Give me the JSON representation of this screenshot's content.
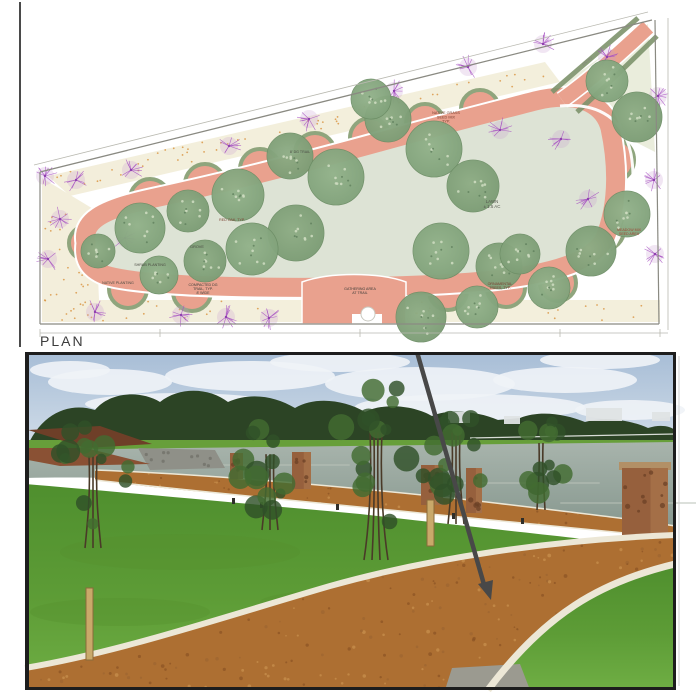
{
  "figure": {
    "plan_title": "PLAN",
    "description_labels": {
      "lawn": "LAWN\n± 1.5 AC"
    }
  },
  "plan": {
    "colors": {
      "trail": "#e9a18e",
      "trailEdge": "#ffffff",
      "bedRim": "#8fa57d",
      "lawn": "#dde3d5",
      "treeFill": "#85a87f",
      "treeFillAlt": "#7a9b72",
      "treeStroke": "#66885f",
      "treeSpeckle": "#ccdabf",
      "treeSpeckleDark": "#5f7f5c",
      "ornamental": "#a64fc2",
      "ornamentalDot": "#8e3fae",
      "ornamentalHalo": "#c79ad1",
      "underplant": "#f0ead2",
      "underplantDot": "#d8913c",
      "boundary": "#8a8a82",
      "boundaryLight": "#b9b9b0",
      "hedge": "#7d926c",
      "paleWedge": "#e6ead6",
      "label": "#3c3c3c"
    },
    "annotations": [
      {
        "x": 446,
        "y": 114,
        "text": "NATIVE GRASS\nSEED MIX\nTYP.",
        "c": "#7a4030",
        "fs": 3.8
      },
      {
        "x": 300,
        "y": 153,
        "text": "8' DG TRAIL",
        "c": "#4a4a42",
        "fs": 3.6
      },
      {
        "x": 492,
        "y": 203,
        "text": "LAWN\n± 1.5 AC",
        "c": "#55584e",
        "fs": 4.4
      },
      {
        "x": 232,
        "y": 221,
        "text": "RED OAK, TYP.",
        "c": "#7a4030",
        "fs": 3.6
      },
      {
        "x": 197,
        "y": 248,
        "text": "GROVE",
        "c": "#4a4a42",
        "fs": 3.8
      },
      {
        "x": 150,
        "y": 266,
        "text": "SHRUB PLANTING",
        "c": "#4a4a42",
        "fs": 3.6
      },
      {
        "x": 118,
        "y": 284,
        "text": "NATIVE PLANTING",
        "c": "#4a4a42",
        "fs": 3.6
      },
      {
        "x": 203,
        "y": 286,
        "text": "COMPACTED DG\nTRAIL, TYP.\n8' WIDE",
        "c": "#3c3c38",
        "fs": 3.6
      },
      {
        "x": 360,
        "y": 290,
        "text": "GATHERING AREA\nAT TRAIL",
        "c": "#3c3c38",
        "fs": 3.6
      },
      {
        "x": 500,
        "y": 285,
        "text": "ORNAMENTAL\nTREES, TYP.",
        "c": "#7a4030",
        "fs": 3.6
      },
      {
        "x": 629,
        "y": 231,
        "text": "MEADOW MIX\nSEED AREA",
        "c": "#a04434",
        "fs": 3.6
      },
      {
        "x": 588,
        "y": 62,
        "text": "ENTRY",
        "c": "#84847c",
        "fs": 3.6,
        "rot": -38
      }
    ],
    "trees_green": [
      [
        140,
        228,
        25
      ],
      [
        188,
        211,
        21
      ],
      [
        238,
        195,
        26
      ],
      [
        290,
        156,
        23
      ],
      [
        336,
        177,
        28
      ],
      [
        296,
        233,
        28
      ],
      [
        252,
        249,
        26
      ],
      [
        205,
        261,
        21
      ],
      [
        159,
        275,
        19
      ],
      [
        388,
        119,
        23
      ],
      [
        434,
        149,
        28
      ],
      [
        473,
        186,
        26
      ],
      [
        441,
        251,
        28
      ],
      [
        499,
        266,
        23
      ],
      [
        549,
        288,
        21
      ],
      [
        591,
        251,
        25
      ],
      [
        627,
        214,
        23
      ],
      [
        637,
        117,
        25
      ],
      [
        607,
        81,
        21
      ],
      [
        421,
        317,
        25
      ],
      [
        477,
        307,
        21
      ],
      [
        98,
        251,
        17
      ],
      [
        371,
        99,
        20
      ],
      [
        520,
        254,
        20
      ]
    ],
    "trees_purple": [
      [
        76,
        180
      ],
      [
        131,
        170
      ],
      [
        229,
        146
      ],
      [
        309,
        119
      ],
      [
        394,
        91
      ],
      [
        468,
        67
      ],
      [
        543,
        44
      ],
      [
        607,
        57
      ],
      [
        658,
        96
      ],
      [
        654,
        180
      ],
      [
        60,
        219
      ],
      [
        48,
        259
      ],
      [
        95,
        312
      ],
      [
        181,
        315
      ],
      [
        269,
        318
      ],
      [
        588,
        199
      ],
      [
        655,
        254
      ],
      [
        561,
        139
      ],
      [
        226,
        317
      ],
      [
        45,
        176
      ],
      [
        125,
        238
      ],
      [
        500,
        130
      ]
    ],
    "scallops": [
      [
        150,
        199,
        20
      ],
      [
        205,
        184,
        20
      ],
      [
        260,
        169,
        20
      ],
      [
        315,
        153,
        20
      ],
      [
        370,
        138,
        20
      ],
      [
        425,
        123,
        19
      ],
      [
        480,
        109,
        19
      ],
      [
        128,
        289,
        19
      ],
      [
        192,
        292,
        19
      ],
      [
        448,
        291,
        19
      ],
      [
        506,
        288,
        19
      ],
      [
        558,
        283,
        18
      ],
      [
        86,
        243,
        17
      ],
      [
        612,
        160,
        22
      ],
      [
        604,
        230,
        20
      ]
    ],
    "dim_ticks": [
      40,
      160,
      360,
      560,
      660
    ]
  },
  "photo": {
    "colors": {
      "skyTop": "#a7bdd6",
      "skyBottom": "#dde6ee",
      "cloud": "#eff3f7",
      "treelineDark": "#2c4425",
      "treelineMid": "#456938",
      "farGrass": "#679f3a",
      "pondTop": "#a8b4ac",
      "pondBottom": "#87988f",
      "pondStreak": "#b9c2b8",
      "grassLight": "#6fae44",
      "grassDark": "#4f8f2e",
      "grassPatch": "#558f2f",
      "pathBrown": "#ad6f32",
      "speckleDark": "#8a5323",
      "speckleLight": "#c9924e",
      "concrete": "#ece7d6",
      "column": "#96603d",
      "columnDark": "#6b4026",
      "columnLight": "#b07c50",
      "cap": "#b29066",
      "wall1": "#6e3f28",
      "wall2": "#8a5134",
      "rocks": "#8f9088",
      "trunk": "#4a3a28",
      "foliageDark": "#2f5128",
      "foliageMid": "#426b31",
      "stake": "#c9a96a",
      "stakeEdge": "#8a6b3a",
      "arrow": "#484848",
      "border": "#1d1d1d",
      "paver": "#9b9a90",
      "house": "#dfe3e4",
      "fence": "#d8dcd6"
    },
    "clouds": [
      [
        110,
        30,
        62,
        13
      ],
      [
        250,
        24,
        85,
        15
      ],
      [
        420,
        32,
        95,
        17
      ],
      [
        565,
        28,
        72,
        13
      ],
      [
        180,
        52,
        95,
        11
      ],
      [
        470,
        55,
        115,
        13
      ],
      [
        630,
        58,
        55,
        10
      ],
      [
        70,
        18,
        40,
        9
      ],
      [
        340,
        10,
        70,
        10
      ],
      [
        600,
        8,
        60,
        9
      ]
    ],
    "houses": [
      [
        448,
        60,
        22,
        11
      ],
      [
        504,
        64,
        16,
        8
      ],
      [
        586,
        56,
        36,
        13
      ],
      [
        652,
        60,
        18,
        9
      ]
    ],
    "columns": [
      [
        230,
        101,
        13,
        26,
        0
      ],
      [
        292,
        100,
        19,
        37,
        0
      ],
      [
        421,
        113,
        22,
        40,
        0
      ],
      [
        466,
        116,
        16,
        45,
        0
      ],
      [
        622,
        116,
        46,
        70,
        1
      ]
    ],
    "trees": [
      [
        93,
        120,
        38,
        52,
        196,
        2
      ],
      [
        270,
        116,
        33,
        46,
        178,
        2
      ],
      [
        376,
        102,
        50,
        72,
        208,
        3
      ],
      [
        456,
        98,
        33,
        58,
        172,
        2
      ],
      [
        541,
        103,
        26,
        40,
        158,
        1
      ]
    ],
    "bollards": [
      [
        232,
        146
      ],
      [
        336,
        152
      ],
      [
        452,
        161
      ],
      [
        521,
        166
      ],
      [
        260,
        150
      ]
    ],
    "stakes": [
      [
        86,
        236,
        7,
        72
      ],
      [
        427,
        148,
        7,
        46
      ]
    ],
    "pond_streaks": [
      [
        200,
        112,
        150
      ],
      [
        420,
        130,
        180
      ],
      [
        560,
        150,
        160
      ]
    ],
    "grass_patches": [
      [
        180,
        200,
        120,
        18
      ],
      [
        420,
        250,
        160,
        16
      ],
      [
        120,
        260,
        90,
        14
      ]
    ]
  }
}
